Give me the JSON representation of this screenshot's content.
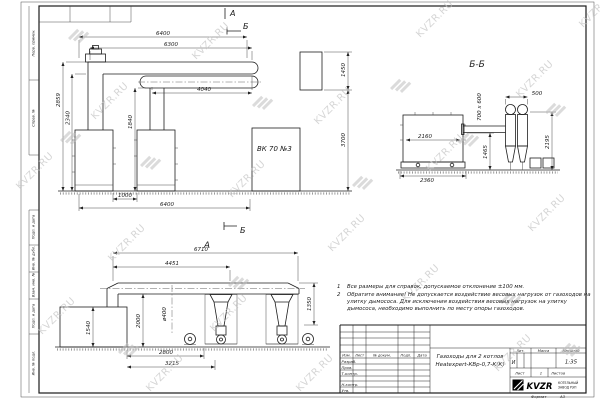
{
  "watermark": {
    "text": "KVZR.RU"
  },
  "margin": {
    "perv": "Перв. примен.",
    "sprav": "Справ. №",
    "podp1": "Подп. и дата",
    "inv_dubl": "Инв. № дубл.",
    "vzam": "Взам. инв. №",
    "podp2": "Подп. и дата",
    "inv_podl": "Инв. № подл."
  },
  "top_view": {
    "section_a": "А",
    "section_b": "Б",
    "dim_6400_top": "6400",
    "dim_6300": "6300",
    "dim_4040": "4040",
    "dim_2859": "2859",
    "dim_2340": "2340",
    "dim_1840": "1840",
    "dim_1000": "1000",
    "dim_6400_bottom": "6400",
    "dim_1450": "1450",
    "dim_3700": "3700",
    "boiler_label": "ВК 70 №3"
  },
  "section_bb": {
    "title": "Б-Б",
    "dim_500": "500",
    "dim_700x600": "700 х 600",
    "dim_2160": "2160",
    "dim_2360": "2360",
    "dim_1465": "1465",
    "dim_2195": "2195"
  },
  "view_a": {
    "title": "А",
    "dim_6710": "6710",
    "dim_4451": "4451",
    "dim_d400": "ø400",
    "dim_2000": "2000",
    "dim_1540": "1540",
    "dim_1350": "1350",
    "dim_2800": "2800",
    "dim_3215": "3215"
  },
  "notes": {
    "n1_num": "1",
    "n1_text": "Все размеры для справок, допускаемое отклонение ±100 мм.",
    "n2_num": "2",
    "n2_text": "Обратите внимание! Не допускается воздействие весовых нагрузок от газоходов на улитку дымососа. Для исключения воздействия весовых нагрузок на улитку дымососа, необходимо выполнить по месту опоры газоходов."
  },
  "title_block": {
    "col_izm": "Изм.",
    "col_list": "Лист",
    "col_doc": "№ докум.",
    "col_podp": "Подп.",
    "col_data": "Дата",
    "row_razrab": "Разраб.",
    "row_prov": "Пров.",
    "row_tkontr": "Т.контр.",
    "row_nkontr": "Н.контр.",
    "row_utv": "Утв.",
    "title_line1": "Газоходы для 2 котлов",
    "title_line2": "Heatexpert-КВр-0,7-К(К)",
    "lit_header": "Лит.",
    "massa_header": "Масса",
    "masshtab_header": "Масштаб",
    "lit_value": "И",
    "scale_value": "1:35",
    "list_label": "Лист",
    "list_value": "1",
    "listov_label": "Листов",
    "logo_text": "KVZR",
    "company_line1": "КОТЕЛЬНЫЙ",
    "company_line2": "ЗАВОД РЭП",
    "format_label": "Формат",
    "format_value": "А3"
  }
}
